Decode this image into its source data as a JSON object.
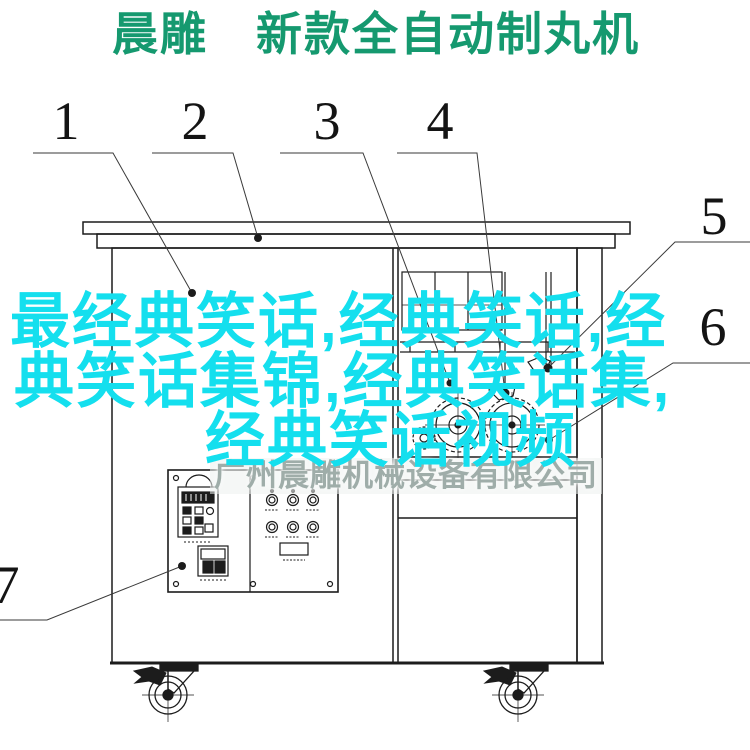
{
  "page": {
    "width": 750,
    "height": 750,
    "background": "#ffffff"
  },
  "title": {
    "text": "晨雕　新款全自动制丸机",
    "color": "#15996f"
  },
  "watermarks": {
    "joke_text": {
      "full_text": "最经典笑话,经典笑话,经典笑话集锦,经典笑话集,经典笑话视频",
      "lines": [
        "最经典笑话,经典笑话,经",
        "典笑话集锦,经典笑话集,",
        "经典笑话视频"
      ],
      "color": "#14dfee"
    },
    "company": {
      "text": "广州晨雕机械设备有限公司",
      "color": "#9fada9"
    }
  },
  "callouts": [
    {
      "label": "1"
    },
    {
      "label": "2"
    },
    {
      "label": "3"
    },
    {
      "label": "4"
    },
    {
      "label": "5"
    },
    {
      "label": "6"
    },
    {
      "label": "7"
    }
  ],
  "drawing": {
    "line_color": "#1c1c1c",
    "leader_line_color": "#3a3a3a"
  }
}
